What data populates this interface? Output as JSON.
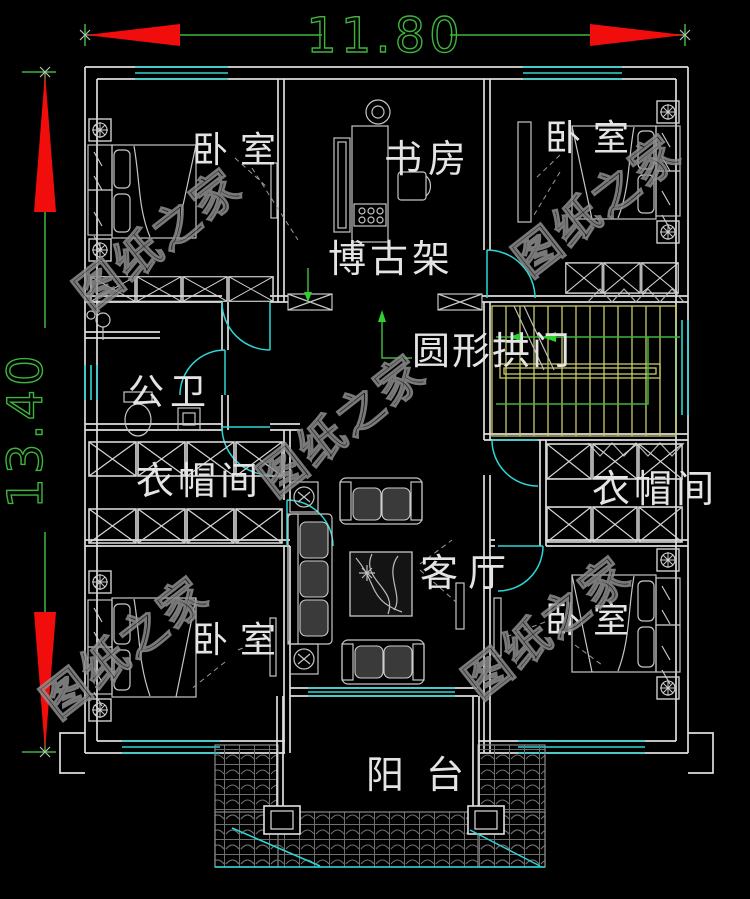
{
  "drawing": {
    "type": "residential floor plan",
    "dimensions": {
      "width_label": "11.80",
      "height_label": "13.40"
    },
    "rooms": {
      "bedroom_top_left": "卧室",
      "study": "书房",
      "bedroom_top_right": "卧室",
      "display_shelf": "博古架",
      "round_arch": "圆形拱门",
      "bathroom": "公卫",
      "cloakroom_left": "衣帽间",
      "cloakroom_right": "衣帽间",
      "living_room": "客厅",
      "bedroom_bottom_left": "卧室",
      "bedroom_bottom_right": "卧室",
      "balcony": "阳台"
    },
    "watermark": {
      "text": "图纸之家"
    },
    "colors": {
      "background": "#000000",
      "wall": "#dedede",
      "window_cyan": "#2fd6d6",
      "dimension_green": "#3db53d",
      "arrow_red": "#f20d0d",
      "stair_yellow": "#caca6a",
      "furniture_gray": "#c6c6c6",
      "watermark_gray": "#8f8f8f",
      "label_white": "#e4e4e4"
    }
  }
}
